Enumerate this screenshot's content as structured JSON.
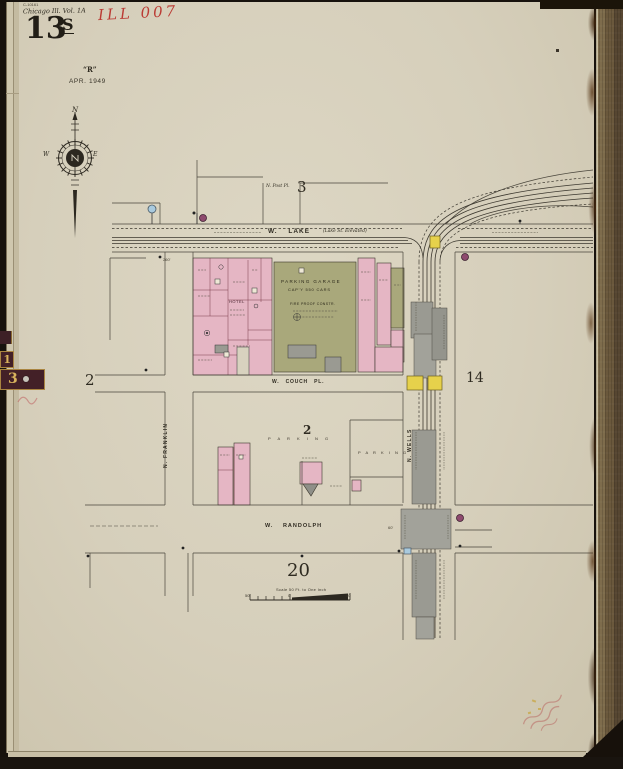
{
  "header": {
    "catalog_tiny": "C-10161",
    "volume_line": "Chicago Ill. Vol. 1A",
    "sheet_number": "13",
    "sheet_suffix": "S",
    "red_accession": "ILL 007",
    "revision_mark": "“R”",
    "date": "APR. 1949"
  },
  "spine_tabs": {
    "tab_upper": "1",
    "tab_lower": "3"
  },
  "compass": {
    "north": "N",
    "west": "W",
    "east": "E"
  },
  "map": {
    "streets": {
      "lake": "W. LAKE",
      "lake_note": "(Lake St. Elevated)",
      "couch": "W. COUCH PL.",
      "randolph": "W. RANDOLPH",
      "franklin": "N. FRANKLIN",
      "wells": "N. WELLS",
      "post_pl": "N. Post Pl."
    },
    "adjoining_sheets": {
      "top": "3",
      "left": "2",
      "right": "14",
      "bottom": "20"
    },
    "block_number": "2",
    "buildings": {
      "garage_name": "PARKING GARAGE",
      "garage_capacity": "CAP'Y 550 CARS",
      "garage_constr": "FIRE PROOF CONSTR.",
      "hotel": "HOTEL",
      "parking_west": "P A R K I N G",
      "parking_east": "P A R K I N G"
    },
    "dimensions": {
      "lake_frontage": "260'",
      "wells_lot": "60'"
    },
    "scale_bar": {
      "caption": "Scale 50 Ft. to One Inch",
      "tick_left": "50",
      "tick_zero": "0",
      "tick_right": "50"
    }
  },
  "legend_colors": {
    "brick_pink": "#e5b6c4",
    "special_olive": "#a9a87b",
    "concrete_gray": "#9a9a92",
    "frame_yellow": "#e6d14b",
    "water_blue": "#a9cade",
    "symbol_purple": "#8e4a6e"
  }
}
